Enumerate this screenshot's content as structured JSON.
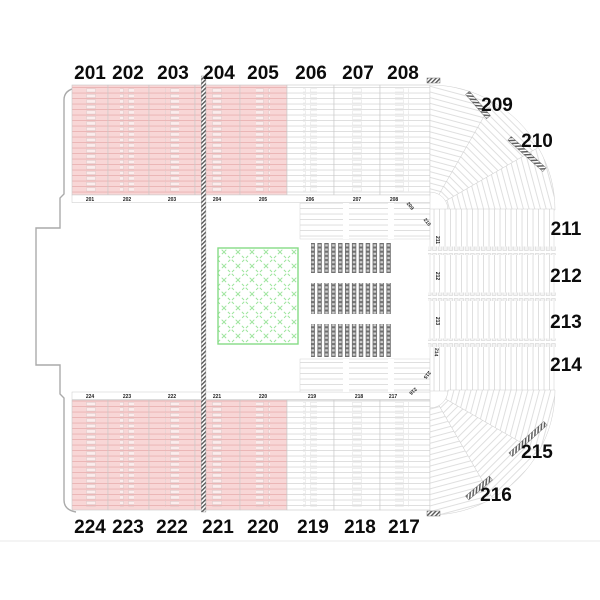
{
  "venue_map": {
    "description": "arena seating chart",
    "legend_colors": {
      "selected_section_fill": "#f8d6d6",
      "selected_row_line": "#eab3b3",
      "available_section_fill": "#ffffff",
      "available_row_line": "#dcdcdc",
      "stage_outline": "#86dc86",
      "floor_seat_color": "#6f6f6f"
    },
    "sections": {
      "top": [
        {
          "label": "201",
          "highlighted": true
        },
        {
          "label": "202",
          "highlighted": true
        },
        {
          "label": "203",
          "highlighted": true
        },
        {
          "label": "204",
          "highlighted": true
        },
        {
          "label": "205",
          "highlighted": true
        },
        {
          "label": "206",
          "highlighted": false
        },
        {
          "label": "207",
          "highlighted": false
        },
        {
          "label": "208",
          "highlighted": false
        }
      ],
      "right": [
        {
          "label": "209",
          "highlighted": false
        },
        {
          "label": "210",
          "highlighted": false
        },
        {
          "label": "211",
          "highlighted": false
        },
        {
          "label": "212",
          "highlighted": false
        },
        {
          "label": "213",
          "highlighted": false
        },
        {
          "label": "214",
          "highlighted": false
        },
        {
          "label": "215",
          "highlighted": false
        },
        {
          "label": "216",
          "highlighted": false
        }
      ],
      "bottom": [
        {
          "label": "224",
          "highlighted": true
        },
        {
          "label": "223",
          "highlighted": true
        },
        {
          "label": "222",
          "highlighted": true
        },
        {
          "label": "221",
          "highlighted": true
        },
        {
          "label": "220",
          "highlighted": true
        },
        {
          "label": "219",
          "highlighted": false
        },
        {
          "label": "218",
          "highlighted": false
        },
        {
          "label": "217",
          "highlighted": false
        }
      ]
    }
  }
}
